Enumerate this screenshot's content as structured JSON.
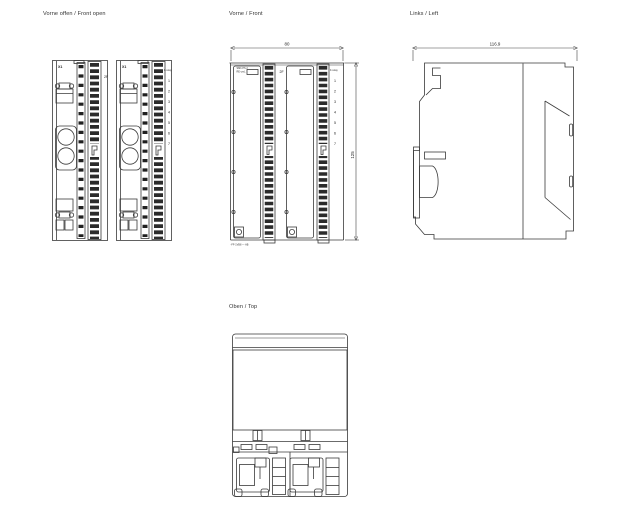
{
  "page": {
    "background": "#ffffff",
    "line_color": "#3a3a3a"
  },
  "views": {
    "front_open": {
      "title": "Vorne offen / Front open",
      "module_label": "X1"
    },
    "front": {
      "title": "Vorne / Front",
      "width_dim": "80",
      "height_dim": "125",
      "door_label_line1": "SMb PS 2",
      "door_label_line2": "RE-cmL",
      "order_number": "-FF-1VB8 — AB"
    },
    "left": {
      "title": "Links / Left",
      "depth_dim": "116.9"
    },
    "top": {
      "title": "Oben / Top"
    }
  },
  "terminals": {
    "mark": "2F",
    "header": "F-relay",
    "numbers": [
      "1",
      "2",
      "3",
      "4",
      "5",
      "6",
      "7"
    ]
  }
}
